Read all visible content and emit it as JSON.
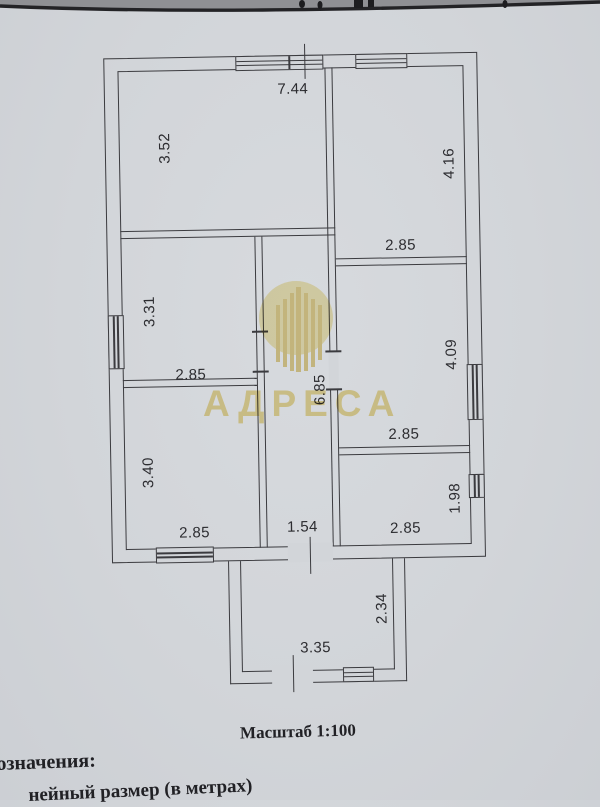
{
  "document": {
    "scale_caption": "Масштаб 1:100",
    "legend_heading_fragment": "означения:",
    "legend_item_fragment": "нейный размер (в метрах)"
  },
  "watermark": {
    "text": "АДРЕСА",
    "color": "#efdc94"
  },
  "plan": {
    "dims": [
      "7.44",
      "3.52",
      "4.16",
      "2.85",
      "3.31",
      "2.85",
      "6.85",
      "4.09",
      "2.85",
      "3.40",
      "2.85",
      "1.54",
      "2.85",
      "1.98",
      "2.34",
      "3.35"
    ]
  },
  "colors": {
    "paper": "#d2d5d9",
    "ink": "#3b3b3f",
    "watermark_yellow": "#f3e6ad"
  }
}
